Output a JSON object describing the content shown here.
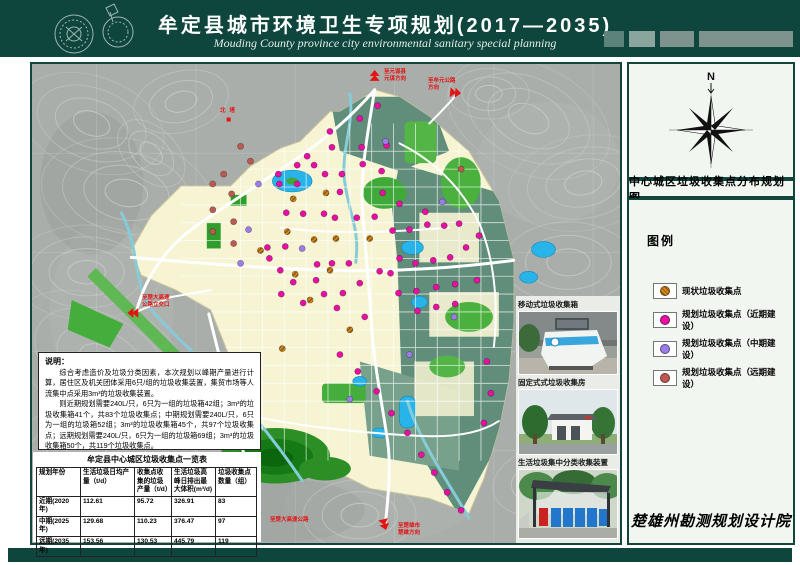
{
  "header": {
    "title": "牟定县城市环境卫生专项规划(2017—2035)",
    "subtitle": "Mouding County province city environmental sanitary special planning"
  },
  "sidebar": {
    "north_label": "N",
    "map_title": "中心城区垃圾收集点分布规划图",
    "legend_title": "图例",
    "legend": [
      {
        "label": "现状垃圾收集点",
        "color": "#d8891c",
        "style": "hatched"
      },
      {
        "label": "规划垃圾收集点（近期建设）",
        "color": "#e810a2",
        "style": "solid"
      },
      {
        "label": "规划垃圾收集点（中期建设）",
        "color": "#9b7ce8",
        "style": "solid"
      },
      {
        "label": "规划垃圾收集点（远期建设）",
        "color": "#bd5a50",
        "style": "solid"
      }
    ],
    "signature": "楚雄州勘测规划设计院"
  },
  "map": {
    "labels": {
      "north_pagoda": "北塔",
      "arrow_north": [
        "至元谋县",
        "元谋方向"
      ],
      "arrow_northeast": [
        "至牟元公路",
        "方向"
      ],
      "arrow_west": [
        "至楚大高速",
        "公路立交口"
      ],
      "arrow_southwest": [
        "至楚大高速公路"
      ],
      "arrow_southeast": [
        "至楚雄市",
        "楚雄方向"
      ]
    },
    "point_colors": {
      "current": "#d8891c",
      "recent": "#e810a2",
      "mid": "#9b7ce8",
      "far": "#bd5a50"
    },
    "points": {
      "recent": [
        [
          302,
          84
        ],
        [
          332,
          84
        ],
        [
          357,
          82
        ],
        [
          277,
          93
        ],
        [
          267,
          102
        ],
        [
          284,
          102
        ],
        [
          333,
          101
        ],
        [
          248,
          111
        ],
        [
          295,
          111
        ],
        [
          312,
          111
        ],
        [
          352,
          108
        ],
        [
          249,
          121
        ],
        [
          267,
          121
        ],
        [
          310,
          129
        ],
        [
          353,
          130
        ],
        [
          370,
          141
        ],
        [
          396,
          149
        ],
        [
          256,
          150
        ],
        [
          273,
          151
        ],
        [
          294,
          151
        ],
        [
          305,
          155
        ],
        [
          327,
          155
        ],
        [
          345,
          154
        ],
        [
          363,
          168
        ],
        [
          380,
          167
        ],
        [
          398,
          162
        ],
        [
          415,
          163
        ],
        [
          430,
          161
        ],
        [
          237,
          185
        ],
        [
          255,
          184
        ],
        [
          287,
          202
        ],
        [
          302,
          201
        ],
        [
          319,
          201
        ],
        [
          239,
          196
        ],
        [
          250,
          208
        ],
        [
          263,
          220
        ],
        [
          286,
          218
        ],
        [
          313,
          231
        ],
        [
          294,
          232
        ],
        [
          273,
          241
        ],
        [
          251,
          232
        ],
        [
          307,
          246
        ],
        [
          330,
          221
        ],
        [
          350,
          209
        ],
        [
          370,
          196
        ],
        [
          361,
          211
        ],
        [
          386,
          201
        ],
        [
          404,
          198
        ],
        [
          421,
          195
        ],
        [
          437,
          185
        ],
        [
          450,
          173
        ],
        [
          369,
          231
        ],
        [
          387,
          229
        ],
        [
          407,
          225
        ],
        [
          426,
          222
        ],
        [
          448,
          218
        ],
        [
          388,
          249
        ],
        [
          407,
          245
        ],
        [
          426,
          242
        ],
        [
          335,
          255
        ],
        [
          310,
          293
        ],
        [
          328,
          310
        ],
        [
          347,
          330
        ],
        [
          362,
          352
        ],
        [
          378,
          372
        ],
        [
          392,
          394
        ],
        [
          405,
          412
        ],
        [
          418,
          432
        ],
        [
          432,
          450
        ],
        [
          458,
          300
        ],
        [
          462,
          332
        ],
        [
          455,
          362
        ],
        [
          300,
          68
        ],
        [
          330,
          55
        ],
        [
          348,
          42
        ]
      ],
      "current": [
        [
          263,
          136
        ],
        [
          296,
          130
        ],
        [
          257,
          169
        ],
        [
          284,
          177
        ],
        [
          306,
          176
        ],
        [
          230,
          188
        ],
        [
          280,
          238
        ],
        [
          320,
          268
        ],
        [
          252,
          287
        ],
        [
          300,
          208
        ],
        [
          340,
          176
        ],
        [
          265,
          212
        ]
      ],
      "mid": [
        [
          228,
          121
        ],
        [
          218,
          167
        ],
        [
          210,
          201
        ],
        [
          413,
          139
        ],
        [
          425,
          255
        ],
        [
          380,
          293
        ],
        [
          320,
          338
        ],
        [
          272,
          186
        ],
        [
          356,
          78
        ]
      ],
      "far": [
        [
          193,
          111
        ],
        [
          182,
          121
        ],
        [
          201,
          131
        ],
        [
          182,
          147
        ],
        [
          203,
          159
        ],
        [
          182,
          169
        ],
        [
          203,
          181
        ],
        [
          220,
          98
        ],
        [
          210,
          83
        ],
        [
          432,
          106
        ]
      ]
    }
  },
  "photos": [
    {
      "caption": "移动式垃圾收集箱"
    },
    {
      "caption": "固定式式垃圾收集房"
    },
    {
      "caption": "生活垃圾集中分类收集装置"
    }
  ],
  "notes": {
    "title": "说明：",
    "paragraphs": [
      "综合考虑造价及垃圾分类因素，本次规划以峰期产量进行计算，居住区及机关团体采用6只/组的垃圾收集装置，集贸市场等人流集中点采用3m³的垃圾收集装置。",
      "则近期规划需要240L/只，6只为一组的垃圾箱42组；3m³的垃圾收集箱41个，共83个垃圾收集点；中期规划需要240L/只，6只为一组的垃圾箱52组；3m³的垃圾收集箱45个，共97个垃圾收集点；远期规划需要240L/只，6只为一组的垃圾箱69组；3m³的垃圾收集箱50个，共119个垃圾收集点。"
    ]
  },
  "table": {
    "title": "牟定县中心城区垃圾收集点一览表",
    "headers": [
      "规划年份",
      "生活垃圾日均产量（t/d）",
      "收集点收集的垃圾产量（t/d）",
      "生活垃圾高峰日排出最大体积(m³/d)",
      "垃圾收集点数量（组）"
    ],
    "rows": [
      [
        "近期(2020 年)",
        "112.61",
        "95.72",
        "326.91",
        "83"
      ],
      [
        "中期(2025 年)",
        "129.68",
        "110.23",
        "376.47",
        "97"
      ],
      [
        "远期(2035 年)",
        "153.56",
        "130.53",
        "445.79",
        "119"
      ]
    ]
  }
}
